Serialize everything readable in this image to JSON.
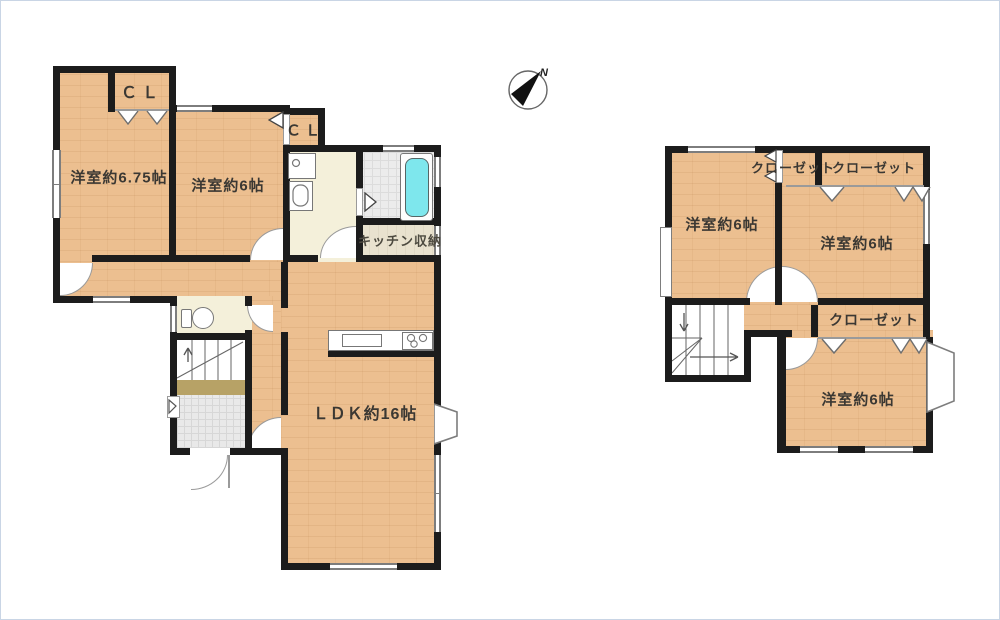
{
  "compass": {
    "north_label": "N"
  },
  "floor1": {
    "room_675": "洋室約6.75帖",
    "room_6": "洋室約6帖",
    "cl1": "ＣＬ",
    "cl2": "ＣＬ",
    "kitchen_storage": "キッチン収納",
    "ldk": "ＬＤＫ約16帖"
  },
  "floor2": {
    "room_nw": "洋室約6帖",
    "room_e": "洋室約6帖",
    "room_se": "洋室約6帖",
    "closet_top_left": "クローゼット",
    "closet_top_right": "クローゼット",
    "closet_mid": "クローゼット"
  },
  "colors": {
    "wall": "#1c1c1c",
    "wood_floor": "#ecbf90",
    "wet_area": "#f4f0da",
    "bath_tile": "#ececec",
    "bathtub": "#7ee7ed",
    "genkan_step": "#b7a266",
    "genkan_tile": "#e9e9e9",
    "storage_floor": "#e9e2cf",
    "label_text": "#3b3833",
    "page_border": "#c9d5e5"
  }
}
